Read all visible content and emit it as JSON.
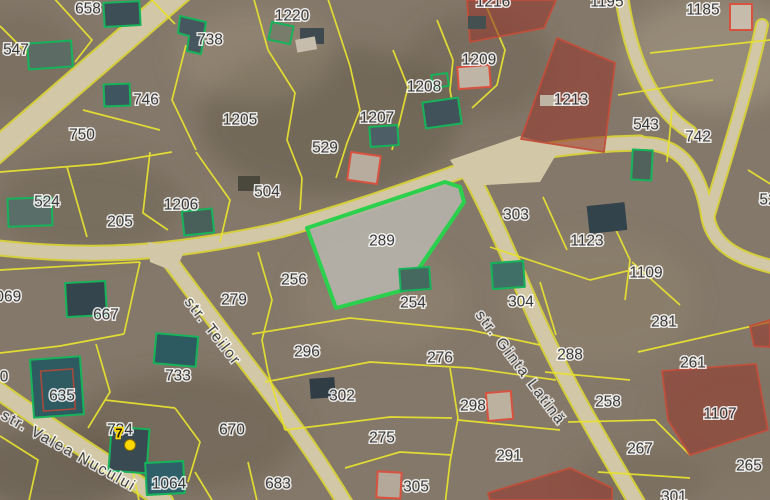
{
  "map": {
    "kind": "cadastral-satellite-view",
    "colors": {
      "ground": "#84786a",
      "parcel_line": "#e6e030",
      "road_fill": "#d2c7a6",
      "selected_parcel_stroke": "#2bd14d",
      "selected_parcel_fill": "#b5b2aa",
      "restricted_parcel_fill": "#943a2e",
      "building_outline_green": "#16b35a",
      "building_outline_red": "#d9523f",
      "label_color": "#3a3a3a",
      "marker_color": "#ffd800"
    },
    "selected_parcel": {
      "number": "289"
    },
    "marker": {
      "label": "7"
    },
    "streets": [
      {
        "name": "str. Teilor"
      },
      {
        "name": "str. Ginta Latină"
      },
      {
        "name": "str. Valea Nucului"
      }
    ],
    "parcel_labels": [
      {
        "text": "658",
        "x": 88,
        "y": 9
      },
      {
        "text": "1220",
        "x": 292,
        "y": 16
      },
      {
        "text": "738",
        "x": 210,
        "y": 40
      },
      {
        "text": "547",
        "x": 16,
        "y": 50
      },
      {
        "text": "746",
        "x": 146,
        "y": 100
      },
      {
        "text": "750",
        "x": 82,
        "y": 135
      },
      {
        "text": "1205",
        "x": 240,
        "y": 120
      },
      {
        "text": "529",
        "x": 325,
        "y": 148
      },
      {
        "text": "1207",
        "x": 377,
        "y": 118
      },
      {
        "text": "1208",
        "x": 424,
        "y": 87
      },
      {
        "text": "1209",
        "x": 479,
        "y": 60
      },
      {
        "text": "1216",
        "x": 493,
        "y": 2
      },
      {
        "text": "1195",
        "x": 607,
        "y": 2
      },
      {
        "text": "1185",
        "x": 703,
        "y": 10
      },
      {
        "text": "1213",
        "x": 571,
        "y": 100
      },
      {
        "text": "543",
        "x": 646,
        "y": 125
      },
      {
        "text": "742",
        "x": 698,
        "y": 137
      },
      {
        "text": "524",
        "x": 47,
        "y": 202
      },
      {
        "text": "205",
        "x": 120,
        "y": 222
      },
      {
        "text": "1206",
        "x": 181,
        "y": 205
      },
      {
        "text": "504",
        "x": 267,
        "y": 192
      },
      {
        "text": "303",
        "x": 516,
        "y": 215
      },
      {
        "text": "1123",
        "x": 587,
        "y": 241
      },
      {
        "text": "1109",
        "x": 646,
        "y": 273
      },
      {
        "text": "281",
        "x": 664,
        "y": 322
      },
      {
        "text": "1069",
        "x": 4,
        "y": 297
      },
      {
        "text": "667",
        "x": 106,
        "y": 315
      },
      {
        "text": "279",
        "x": 234,
        "y": 300
      },
      {
        "text": "256",
        "x": 294,
        "y": 280
      },
      {
        "text": "289",
        "x": 382,
        "y": 241
      },
      {
        "text": "254",
        "x": 413,
        "y": 303
      },
      {
        "text": "304",
        "x": 521,
        "y": 302
      },
      {
        "text": "288",
        "x": 570,
        "y": 355
      },
      {
        "text": "261",
        "x": 693,
        "y": 363
      },
      {
        "text": "52",
        "x": 768,
        "y": 200
      },
      {
        "text": "296",
        "x": 307,
        "y": 352
      },
      {
        "text": "276",
        "x": 440,
        "y": 358
      },
      {
        "text": "302",
        "x": 342,
        "y": 396
      },
      {
        "text": "298",
        "x": 473,
        "y": 406
      },
      {
        "text": "258",
        "x": 608,
        "y": 402
      },
      {
        "text": "1107",
        "x": 720,
        "y": 414
      },
      {
        "text": "267",
        "x": 640,
        "y": 449
      },
      {
        "text": "265",
        "x": 749,
        "y": 466
      },
      {
        "text": "635",
        "x": 62,
        "y": 396
      },
      {
        "text": "733",
        "x": 178,
        "y": 376
      },
      {
        "text": "670",
        "x": 232,
        "y": 430
      },
      {
        "text": "734",
        "x": 120,
        "y": 430
      },
      {
        "text": "1064",
        "x": 169,
        "y": 484
      },
      {
        "text": "683",
        "x": 278,
        "y": 484
      },
      {
        "text": "275",
        "x": 382,
        "y": 438
      },
      {
        "text": "291",
        "x": 509,
        "y": 456
      },
      {
        "text": "305",
        "x": 416,
        "y": 487
      },
      {
        "text": "301",
        "x": 674,
        "y": 497
      },
      {
        "text": "0",
        "x": 4,
        "y": 377
      }
    ]
  }
}
